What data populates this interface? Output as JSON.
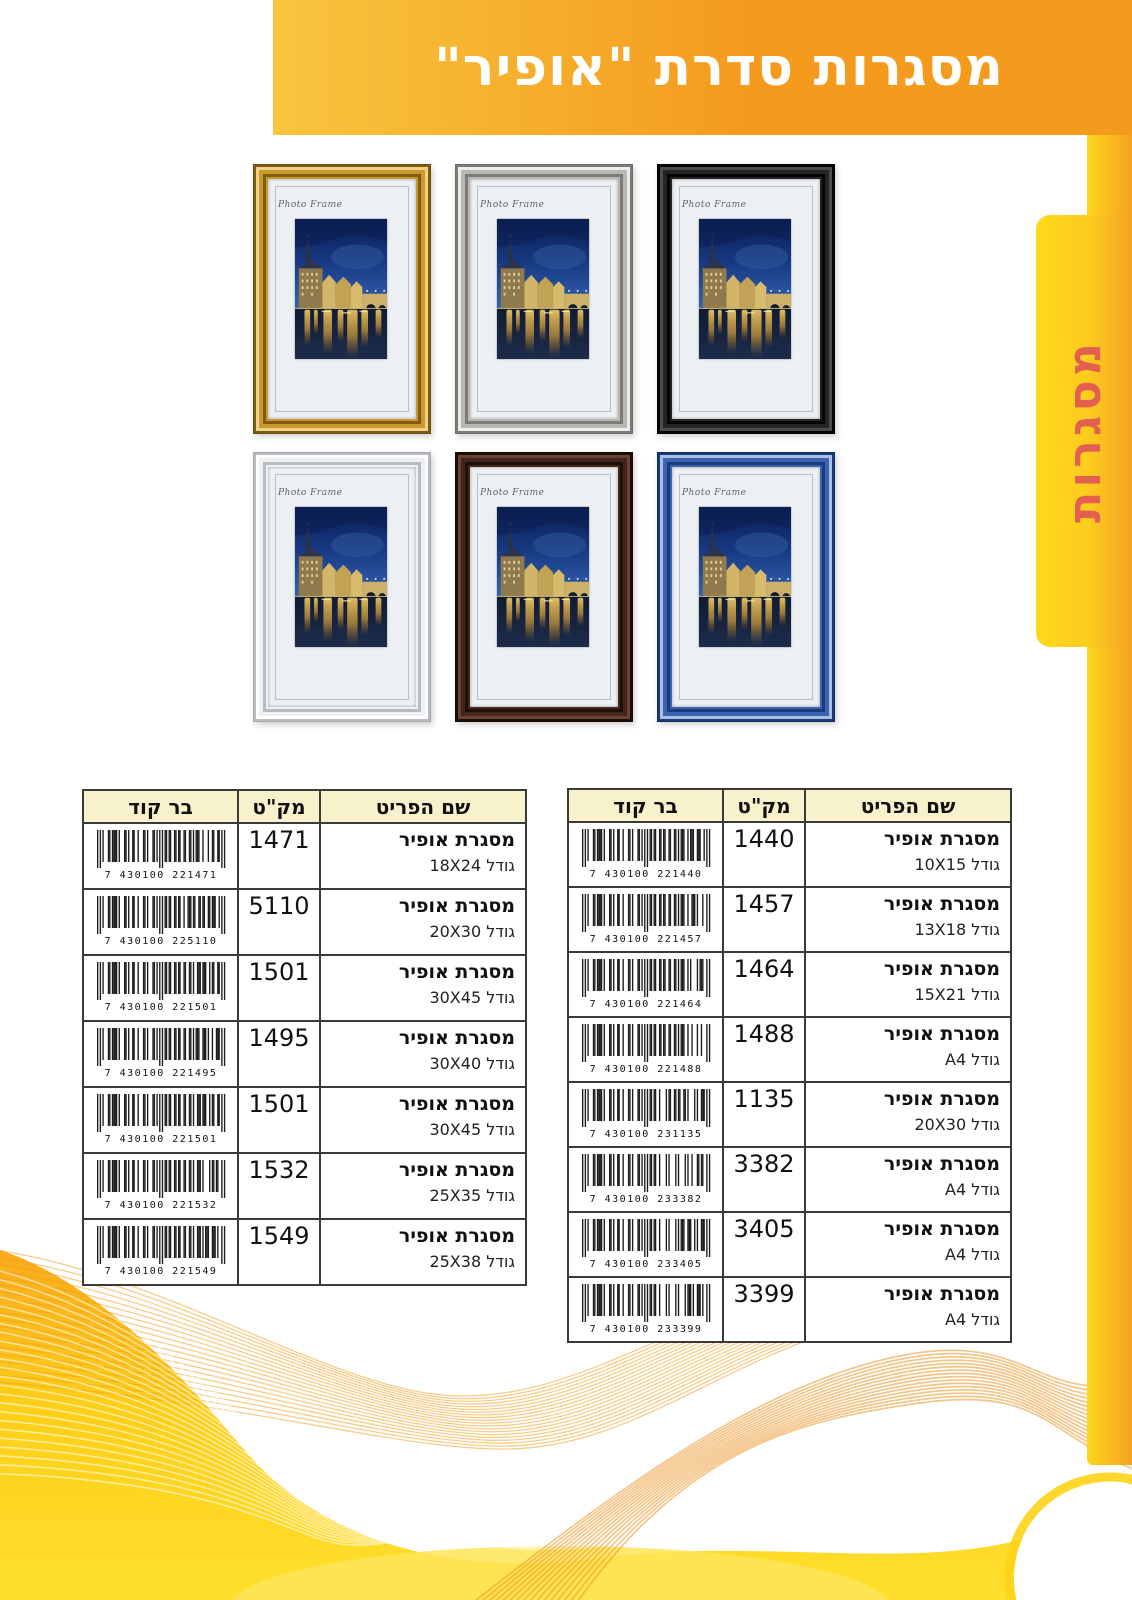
{
  "header": {
    "title": "מסגרות סדרת \"אופיר\""
  },
  "side_tab": {
    "label": "מסגרות"
  },
  "gallery": {
    "photo_label": "Photo Frame",
    "frames": [
      {
        "id": "gold",
        "main": "#c9992e",
        "light": "#eed387",
        "dark": "#7e5c14",
        "edge": "#6b4e10"
      },
      {
        "id": "silver",
        "main": "#b9b7b2",
        "light": "#efedea",
        "dark": "#7c7b77",
        "edge": "#6f6e6a"
      },
      {
        "id": "black",
        "main": "#242424",
        "light": "#4d4d4d",
        "dark": "#050505",
        "edge": "#000000"
      },
      {
        "id": "white",
        "main": "#eef0f2",
        "light": "#ffffff",
        "dark": "#b6bcc2",
        "edge": "#a3a9af"
      },
      {
        "id": "brown",
        "main": "#43251a",
        "light": "#6d4232",
        "dark": "#1d0e08",
        "edge": "#160a06"
      },
      {
        "id": "blue",
        "main": "#3a64b0",
        "light": "#a9c0e4",
        "dark": "#1b3a7c",
        "edge": "#122c61"
      }
    ]
  },
  "tables": {
    "columns": {
      "item": "שם הפריט",
      "sku": "מק\"ט",
      "barcode": "בר קוד"
    },
    "item_name": "מסגרת אופיר",
    "size_prefix": "גודל",
    "left_table": {
      "rows": [
        {
          "sku": "1471",
          "size": "18X24",
          "barcode": "7 430100 221471"
        },
        {
          "sku": "5110",
          "size": "20X30",
          "barcode": "7 430100 225110"
        },
        {
          "sku": "1501",
          "size": "30X45",
          "barcode": "7 430100 221501"
        },
        {
          "sku": "1495",
          "size": "30X40",
          "barcode": "7 430100 221495"
        },
        {
          "sku": "1501",
          "size": "30X45",
          "barcode": "7 430100 221501"
        },
        {
          "sku": "1532",
          "size": "25X35",
          "barcode": "7 430100 221532"
        },
        {
          "sku": "1549",
          "size": "25X38",
          "barcode": "7 430100 221549"
        }
      ]
    },
    "right_table": {
      "rows": [
        {
          "sku": "1440",
          "size": "10X15",
          "barcode": "7 430100 221440"
        },
        {
          "sku": "1457",
          "size": "13X18",
          "barcode": "7 430100 221457"
        },
        {
          "sku": "1464",
          "size": "15X21",
          "barcode": "7 430100 221464"
        },
        {
          "sku": "1488",
          "size": "A4",
          "barcode": "7 430100 221488"
        },
        {
          "sku": "1135",
          "size": "20X30",
          "barcode": "7 430100 231135"
        },
        {
          "sku": "3382",
          "size": "A4",
          "barcode": "7 430100 233382"
        },
        {
          "sku": "3405",
          "size": "A4",
          "barcode": "7 430100 233405"
        },
        {
          "sku": "3399",
          "size": "A4",
          "barcode": "7 430100 233399"
        }
      ]
    }
  },
  "colors": {
    "banner_from": "#f8c53e",
    "banner_to": "#f49b1e",
    "tab_from": "#ffd91c",
    "tab_to": "#f4a322",
    "tab_text": "#e2604d",
    "table_header_bg": "#f8f2cc",
    "table_border": "#3a3a3a",
    "wave_yellow": "#fdd018",
    "wave_orange": "#f29c17"
  }
}
